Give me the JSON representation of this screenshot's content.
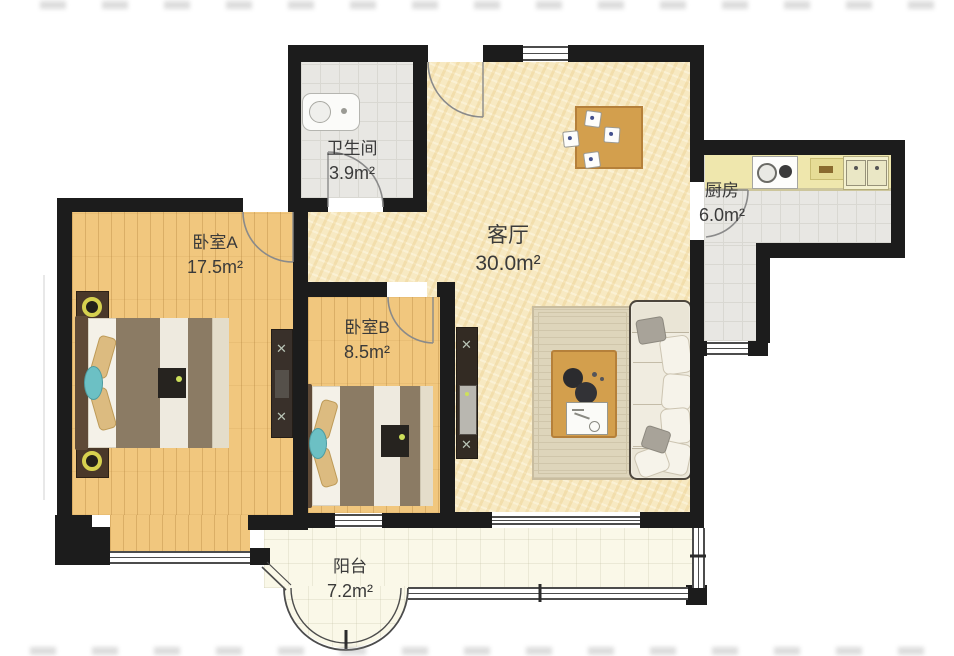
{
  "rooms": [
    {
      "id": "bathroom",
      "name": "卫生间",
      "area": "3.9m²"
    },
    {
      "id": "living",
      "name": "客厅",
      "area": "30.0m²"
    },
    {
      "id": "kitchen",
      "name": "厨房",
      "area": "6.0m²"
    },
    {
      "id": "bedroomA",
      "name": "卧室A",
      "area": "17.5m²"
    },
    {
      "id": "bedroomB",
      "name": "卧室B",
      "area": "8.5m²"
    },
    {
      "id": "balcony",
      "name": "阳台",
      "area": "7.2m²"
    }
  ],
  "palette": {
    "wall": "#1c1c1c",
    "wood_floor": "#f1c77e",
    "living_floor": "#f7e9c2",
    "tile_floor": "#e8e7e3",
    "balcony_floor": "#faf8e8",
    "kitchen_counter": "#efe7ad",
    "bed_blanket": "#8b7b64",
    "sofa": "#f0ece0",
    "table_wood": "#d39f4d",
    "accent_teal": "#6cc0c4",
    "lamp_ring": "#d6d14f",
    "label_text": "#3a3a3a"
  }
}
